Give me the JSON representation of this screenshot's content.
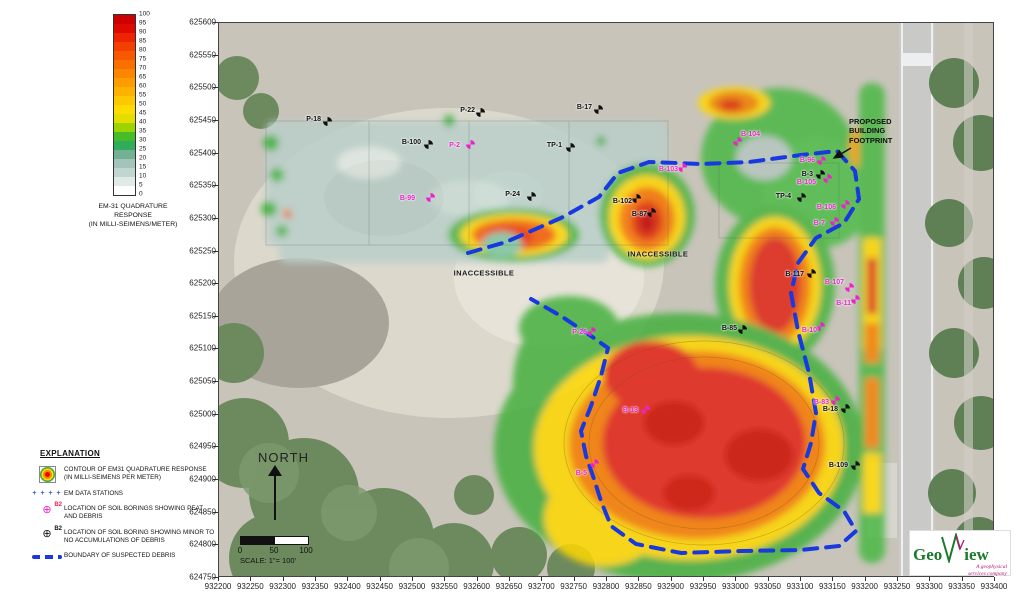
{
  "axes": {
    "x_ticks": [
      "932200",
      "932250",
      "932300",
      "932350",
      "932400",
      "932450",
      "932500",
      "932550",
      "932600",
      "932650",
      "932700",
      "932750",
      "932800",
      "932850",
      "932900",
      "932950",
      "933000",
      "933050",
      "933100",
      "933150",
      "933200",
      "933250",
      "933300",
      "933350",
      "933400"
    ],
    "y_ticks": [
      "625600",
      "625550",
      "625500",
      "625450",
      "625400",
      "625350",
      "625300",
      "625250",
      "625200",
      "625150",
      "625100",
      "625050",
      "625000",
      "624950",
      "624900",
      "624850",
      "624800",
      "624750"
    ]
  },
  "color_scale": {
    "ticks": [
      "100",
      "95",
      "90",
      "85",
      "80",
      "75",
      "70",
      "65",
      "60",
      "55",
      "50",
      "45",
      "40",
      "35",
      "30",
      "25",
      "20",
      "15",
      "10",
      "5",
      "0"
    ],
    "cells": [
      "#cc0000",
      "#de0a00",
      "#ec2400",
      "#f34000",
      "#f85800",
      "#fa7000",
      "#fc8600",
      "#fd9c00",
      "#feb200",
      "#fec800",
      "#ffdc00",
      "#e4de00",
      "#9cd400",
      "#46bc28",
      "#30ac5a",
      "#74b094",
      "#a2c4ba",
      "#c2d6d0",
      "#e0ebe7",
      "#ffffff"
    ],
    "caption_lines": [
      "EM-31 QUADRATURE",
      "RESPONSE",
      "(IN MILLI-SEIMENS/METER)"
    ]
  },
  "map": {
    "inaccessible_labels": [
      {
        "text": "INACCESSIBLE",
        "x": 484,
        "y": 273
      },
      {
        "text": "INACCESSIBLE",
        "x": 658,
        "y": 254
      }
    ],
    "building_callout": {
      "lines": [
        "PROPOSED",
        "BUILDING",
        "FOOTPRINT"
      ]
    },
    "stations": [
      {
        "id": "P-18",
        "type": "minor",
        "mx": 327,
        "my": 121,
        "lx": 321,
        "ly": 120,
        "a": "e"
      },
      {
        "id": "P-22",
        "type": "minor",
        "mx": 480,
        "my": 112,
        "lx": 475,
        "ly": 111,
        "a": "e"
      },
      {
        "id": "B-17",
        "type": "minor",
        "mx": 598,
        "my": 109,
        "lx": 592,
        "ly": 108,
        "a": "e"
      },
      {
        "id": "B-100",
        "type": "minor",
        "mx": 428,
        "my": 144,
        "lx": 421,
        "ly": 143,
        "a": "e"
      },
      {
        "id": "TP-1",
        "type": "minor",
        "mx": 570,
        "my": 147,
        "lx": 562,
        "ly": 146,
        "a": "e"
      },
      {
        "id": "P-24",
        "type": "minor",
        "mx": 531,
        "my": 196,
        "lx": 520,
        "ly": 195,
        "a": "e"
      },
      {
        "id": "B-102",
        "type": "minor",
        "mx": 636,
        "my": 198,
        "lx": 632,
        "ly": 202,
        "a": "e"
      },
      {
        "id": "B-87",
        "type": "minor",
        "mx": 651,
        "my": 212,
        "lx": 647,
        "ly": 215,
        "a": "e"
      },
      {
        "id": "B-3",
        "type": "minor",
        "mx": 820,
        "my": 174,
        "lx": 813,
        "ly": 175,
        "a": "e"
      },
      {
        "id": "TP-4",
        "type": "minor",
        "mx": 801,
        "my": 197,
        "lx": 791,
        "ly": 197,
        "a": "e"
      },
      {
        "id": "B-117",
        "type": "minor",
        "mx": 811,
        "my": 273,
        "lx": 804,
        "ly": 275,
        "a": "e"
      },
      {
        "id": "B-85",
        "type": "minor",
        "mx": 742,
        "my": 329,
        "lx": 737,
        "ly": 329,
        "a": "e"
      },
      {
        "id": "B-18",
        "type": "minor",
        "mx": 845,
        "my": 408,
        "lx": 838,
        "ly": 410,
        "a": "e"
      },
      {
        "id": "B-109",
        "type": "minor",
        "mx": 855,
        "my": 465,
        "lx": 848,
        "ly": 466,
        "a": "e"
      },
      {
        "id": "P-2",
        "type": "peat",
        "mx": 470,
        "my": 144,
        "lx": 460,
        "ly": 146,
        "a": "e"
      },
      {
        "id": "B-99",
        "type": "peat",
        "mx": 430,
        "my": 197,
        "lx": 415,
        "ly": 199,
        "a": "e"
      },
      {
        "id": "B-103",
        "type": "peat",
        "mx": 682,
        "my": 167,
        "lx": 678,
        "ly": 170,
        "a": "e"
      },
      {
        "id": "B-104",
        "type": "peat",
        "mx": 737,
        "my": 141,
        "lx": 741,
        "ly": 135,
        "a": "s"
      },
      {
        "id": "B-96",
        "type": "peat",
        "mx": 821,
        "my": 160,
        "lx": 815,
        "ly": 161,
        "a": "e"
      },
      {
        "id": "B-105",
        "type": "peat",
        "mx": 827,
        "my": 178,
        "lx": 816,
        "ly": 183,
        "a": "e"
      },
      {
        "id": "B-106",
        "type": "peat",
        "mx": 845,
        "my": 204,
        "lx": 836,
        "ly": 208,
        "a": "e"
      },
      {
        "id": "B-7",
        "type": "peat",
        "mx": 834,
        "my": 221,
        "lx": 825,
        "ly": 224,
        "a": "e"
      },
      {
        "id": "B-107",
        "type": "peat",
        "mx": 849,
        "my": 287,
        "lx": 844,
        "ly": 283,
        "a": "e"
      },
      {
        "id": "B-11",
        "type": "peat",
        "mx": 855,
        "my": 299,
        "lx": 851,
        "ly": 304,
        "a": "e"
      },
      {
        "id": "B-10",
        "type": "peat",
        "mx": 820,
        "my": 326,
        "lx": 817,
        "ly": 331,
        "a": "e"
      },
      {
        "id": "P-26",
        "type": "peat",
        "mx": 591,
        "my": 331,
        "lx": 587,
        "ly": 333,
        "a": "e"
      },
      {
        "id": "B-13",
        "type": "peat",
        "mx": 645,
        "my": 409,
        "lx": 638,
        "ly": 411,
        "a": "e"
      },
      {
        "id": "B-83",
        "type": "peat",
        "mx": 835,
        "my": 400,
        "lx": 829,
        "ly": 403,
        "a": "e"
      },
      {
        "id": "B-5",
        "type": "peat",
        "mx": 594,
        "my": 463,
        "lx": 587,
        "ly": 474,
        "a": "e"
      }
    ]
  },
  "compass": {
    "label": "NORTH"
  },
  "scale_bar": {
    "labels": [
      "0",
      "50",
      "100"
    ],
    "caption": "SCALE: 1\"= 100'"
  },
  "explanation": {
    "title": "EXPLANATION",
    "items": [
      {
        "symbol": "contour",
        "lines": [
          "CONTOUR OF EM31 QUADRATURE RESPONSE",
          "(IN MILLI-SEIMENS PER METER)"
        ]
      },
      {
        "symbol": "em-stations",
        "glyph": "+ + + +",
        "lines": [
          "EM DATA STATIONS"
        ]
      },
      {
        "symbol": "boring-peat",
        "glyph": "⊕",
        "tag": "B2",
        "lines": [
          "LOCATION OF SOIL BORINGS SHOWING PEAT",
          "AND DEBRIS"
        ]
      },
      {
        "symbol": "boring-minor",
        "glyph": "⊕",
        "tag": "B2",
        "lines": [
          "LOCATION OF SOIL BORING SHOWING MINOR TO",
          "NO ACCUMULATIONS OF DEBRIS"
        ]
      },
      {
        "symbol": "boundary",
        "lines": [
          "BOUNDARY OF SUSPECTED DEBRIS"
        ]
      }
    ]
  },
  "logo": {
    "geo": "Geo",
    "view": "iew",
    "tagline_1": "A geophysical",
    "tagline_2": "services company"
  },
  "colors": {
    "boundary": "#1838e0",
    "peat": "#ee22cc",
    "minor": "#101010",
    "em_station": "#3366cc"
  }
}
